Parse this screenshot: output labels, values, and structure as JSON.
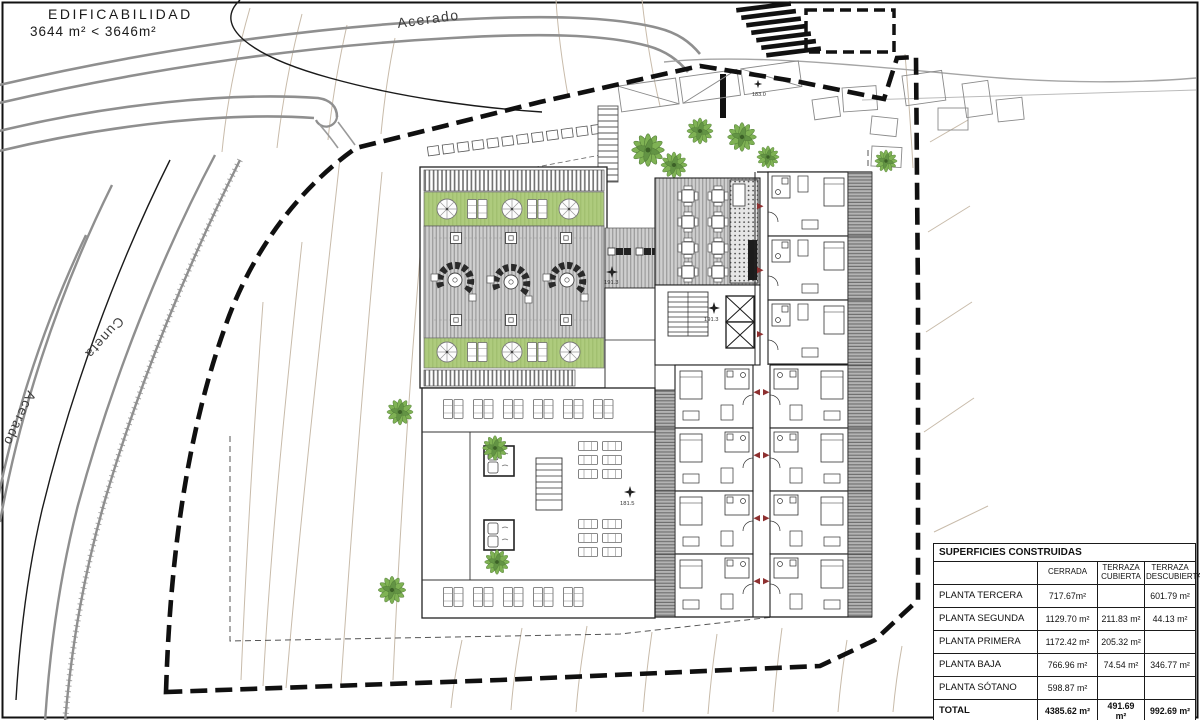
{
  "title_block": {
    "line1": "EDIFICABILIDAD",
    "line2": "3644 m²  <  3646m²"
  },
  "road_labels": {
    "top": "Acerado",
    "left_upper": "Cuneta",
    "left_lower": "Acerado"
  },
  "level_markers": {
    "roof_deck": "191.3",
    "core": "191.3",
    "pool_deck": "181.5",
    "entry": "183.0"
  },
  "areas_table": {
    "title": "SUPERFICIES CONSTRUIDAS",
    "columns": [
      "CERRADA",
      "TERRAZA CUBIERTA",
      "TERRAZA DESCUBIERTA"
    ],
    "rows": [
      {
        "label": "PLANTA TERCERA",
        "cerrada": "717.67m²",
        "terraza_cubierta": "",
        "terraza_descubierta": "601.79 m²"
      },
      {
        "label": "PLANTA SEGUNDA",
        "cerrada": "1129.70 m²",
        "terraza_cubierta": "211.83 m²",
        "terraza_descubierta": "44.13 m²"
      },
      {
        "label": "PLANTA PRIMERA",
        "cerrada": "1172.42 m²",
        "terraza_cubierta": "205.32 m²",
        "terraza_descubierta": ""
      },
      {
        "label": "PLANTA BAJA",
        "cerrada": "766.96 m²",
        "terraza_cubierta": "74.54 m²",
        "terraza_descubierta": "346.77 m²"
      },
      {
        "label": "PLANTA SÓTANO",
        "cerrada": "598.87 m²",
        "terraza_cubierta": "",
        "terraza_descubierta": ""
      },
      {
        "label": "TOTAL",
        "cerrada": "4385.62 m²",
        "terraza_cubierta": "491.69 m²",
        "terraza_descubierta": "992.69 m²"
      }
    ]
  },
  "colors": {
    "planter_green": "#aecb7d",
    "deck_gray": "#cfcfcf",
    "boundary_black": "#101010",
    "contour_tan": "#c8bbaa",
    "road_gray": "#8f8f8f",
    "arrow_red": "#8e3030"
  }
}
